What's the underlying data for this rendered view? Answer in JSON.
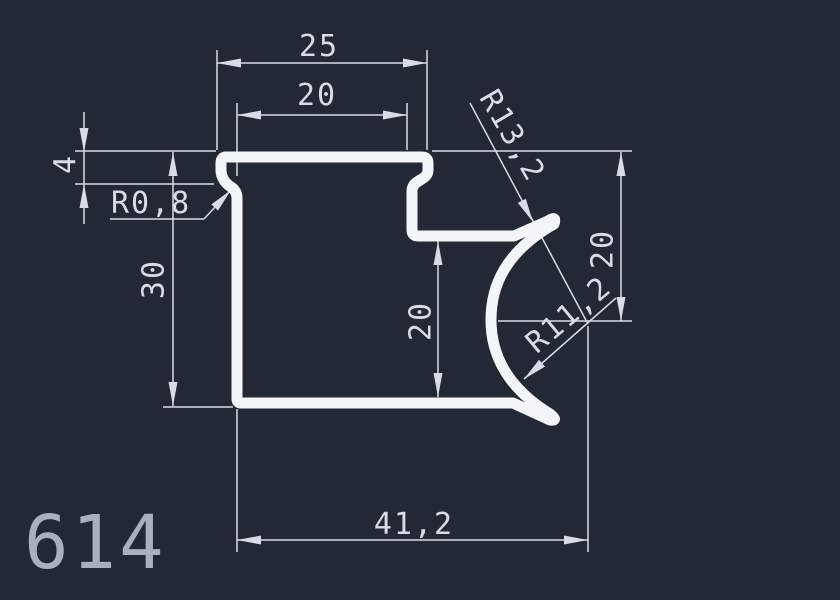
{
  "drawing": {
    "part_number": "614",
    "dimensions": {
      "width_top": "25",
      "width_top_inner": "20",
      "tab_height": "4",
      "fillet_radius": "R0,8",
      "height_left": "30",
      "height_mid": "20",
      "height_right": "20",
      "radius_outer": "R13,2",
      "radius_inner": "R11,2",
      "width_total": "41,2"
    },
    "colors": {
      "background": "#222834",
      "profile": "#f3f5f8",
      "dimension": "#d7dce5",
      "part_label": "#a9b0bd"
    }
  }
}
